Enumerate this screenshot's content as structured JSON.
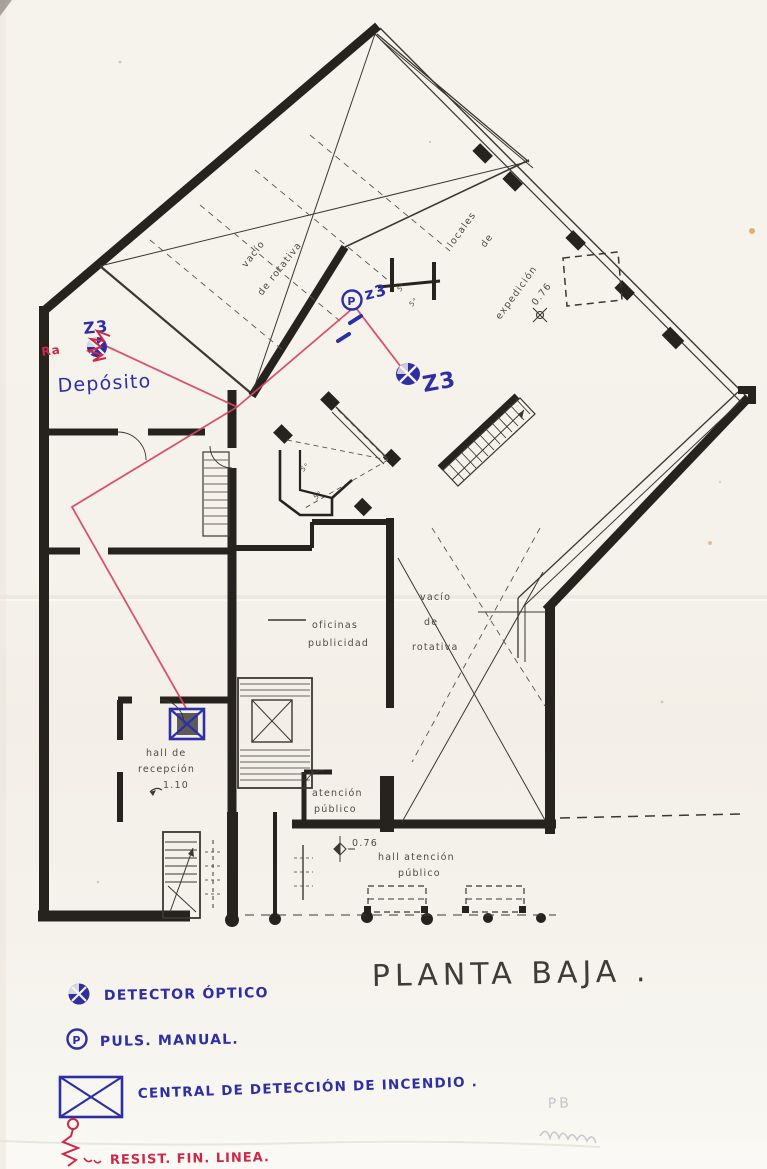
{
  "title": "PLANTA BAJA .",
  "plan_labels": {
    "vacio_upper_1": "vacío",
    "vacio_upper_2": "de rotativa",
    "locales_1": "locales",
    "locales_2": "de",
    "locales_3": "expedición",
    "level_top": "0.76",
    "oficinas_1": "oficinas",
    "oficinas_2": "publicidad",
    "vacio_lower_1": "vacío",
    "vacio_lower_2": "de",
    "vacio_lower_3": "rotativa",
    "hall_recepcion_1": "hall de",
    "hall_recepcion_2": "recepción",
    "hall_recepcion_level": "1.10",
    "atencion_1": "atención",
    "atencion_2": "público",
    "hall_atencion_level": "0.76",
    "hall_atencion_1": "hall atención",
    "hall_atencion_2": "público",
    "small_rooms": [
      "5°",
      "5°",
      "5°",
      "5°"
    ]
  },
  "annotations": {
    "z3_deposito": "Z3",
    "z3_pulsador": "z3",
    "z3_detector": "Z3",
    "deposito_label": "Depósito",
    "resistor_label": "Ra",
    "p_letter": "P",
    "faint_note": "PB"
  },
  "legend": {
    "items": [
      {
        "symbol": "optical-detector",
        "label": "DETECTOR ÓPTICO"
      },
      {
        "symbol": "manual-call-point",
        "label": "PULS. MANUAL."
      },
      {
        "symbol": "fire-control-panel",
        "label": "CENTRAL DE DETECCIÓN DE INCENDIO ."
      },
      {
        "symbol": "end-of-line-resistor",
        "label": "RESIST. FIN. LINEA."
      }
    ]
  },
  "colors": {
    "ink_blue": "#2d2fa3",
    "ink_red": "#d64563",
    "plan_black": "#26231f",
    "paper": "#f6f3ed",
    "pencil": "#b4b4c2"
  }
}
